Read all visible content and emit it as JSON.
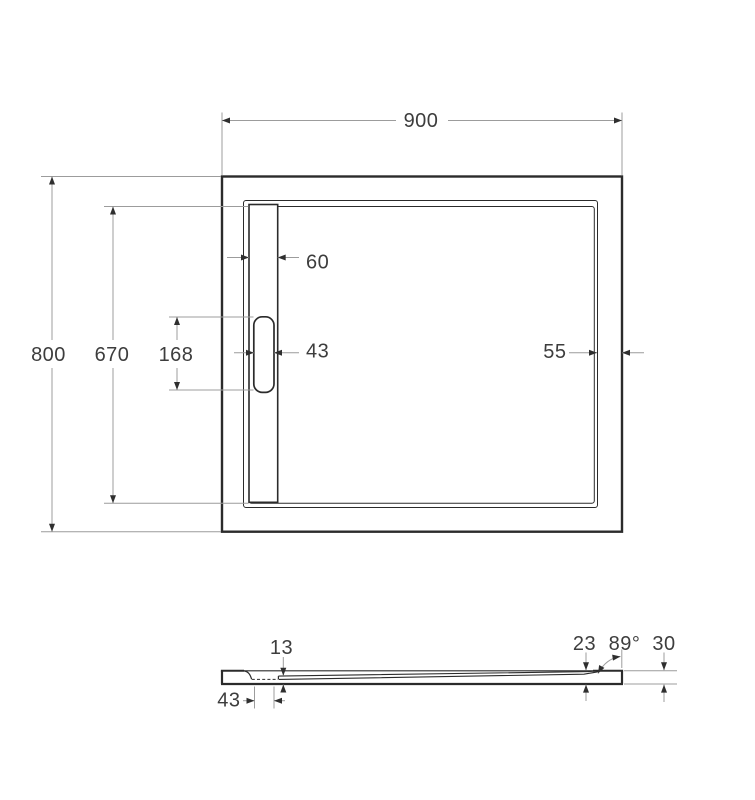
{
  "drawing": {
    "background": "#ffffff",
    "line_color": "#2b2b2b",
    "dimension_line_color": "#9c9c9c",
    "dimension_text_color": "#3d3d3d",
    "plan": {
      "overall_width": "900",
      "overall_depth": "800",
      "basin_length": "670",
      "drain_slot_length": "168",
      "channel_cover_width": "60",
      "drain_slot_width": "43",
      "right_rim_width": "55"
    },
    "section": {
      "floor_thickness_at_drain": "13",
      "drain_recess_width": "43",
      "floor_thickness_at_edge": "23",
      "wall_angle": "89°",
      "overall_height": "30"
    }
  }
}
